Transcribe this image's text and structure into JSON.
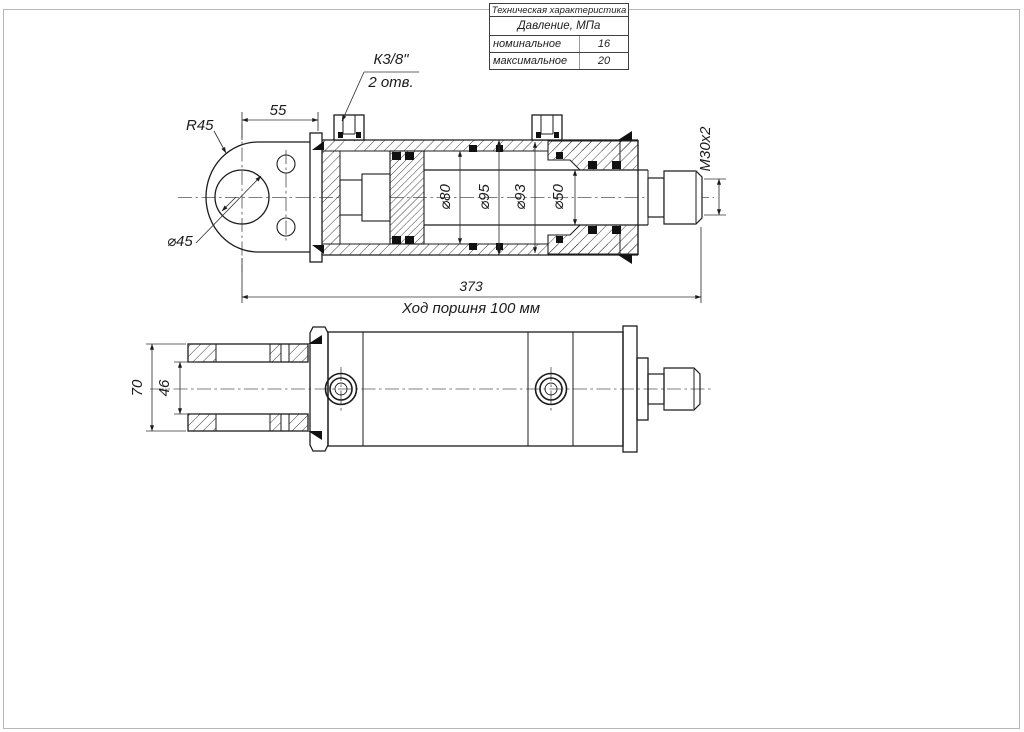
{
  "spec_table": {
    "title": "Техническая характеристика",
    "group_header": "Давление, МПа",
    "rows": [
      {
        "label": "номинальное",
        "value": "16"
      },
      {
        "label": "максимальное",
        "value": "20"
      }
    ]
  },
  "top_view": {
    "labels": {
      "port_thread": "К3/8\"",
      "port_count": "2 отв.",
      "eye_radius": "R45",
      "eye_hole_dia": "⌀45",
      "pin_offset": "55",
      "bore_dia": "⌀80",
      "tube_outer_dia": "⌀95",
      "gland_dia": "⌀93",
      "rod_dia": "⌀50",
      "rod_thread": "М30х2",
      "overall_length": "373",
      "stroke_note": "Ход поршня 100 мм"
    }
  },
  "side_view": {
    "labels": {
      "fork_outer_width": "70",
      "fork_inner_width": "46"
    }
  }
}
